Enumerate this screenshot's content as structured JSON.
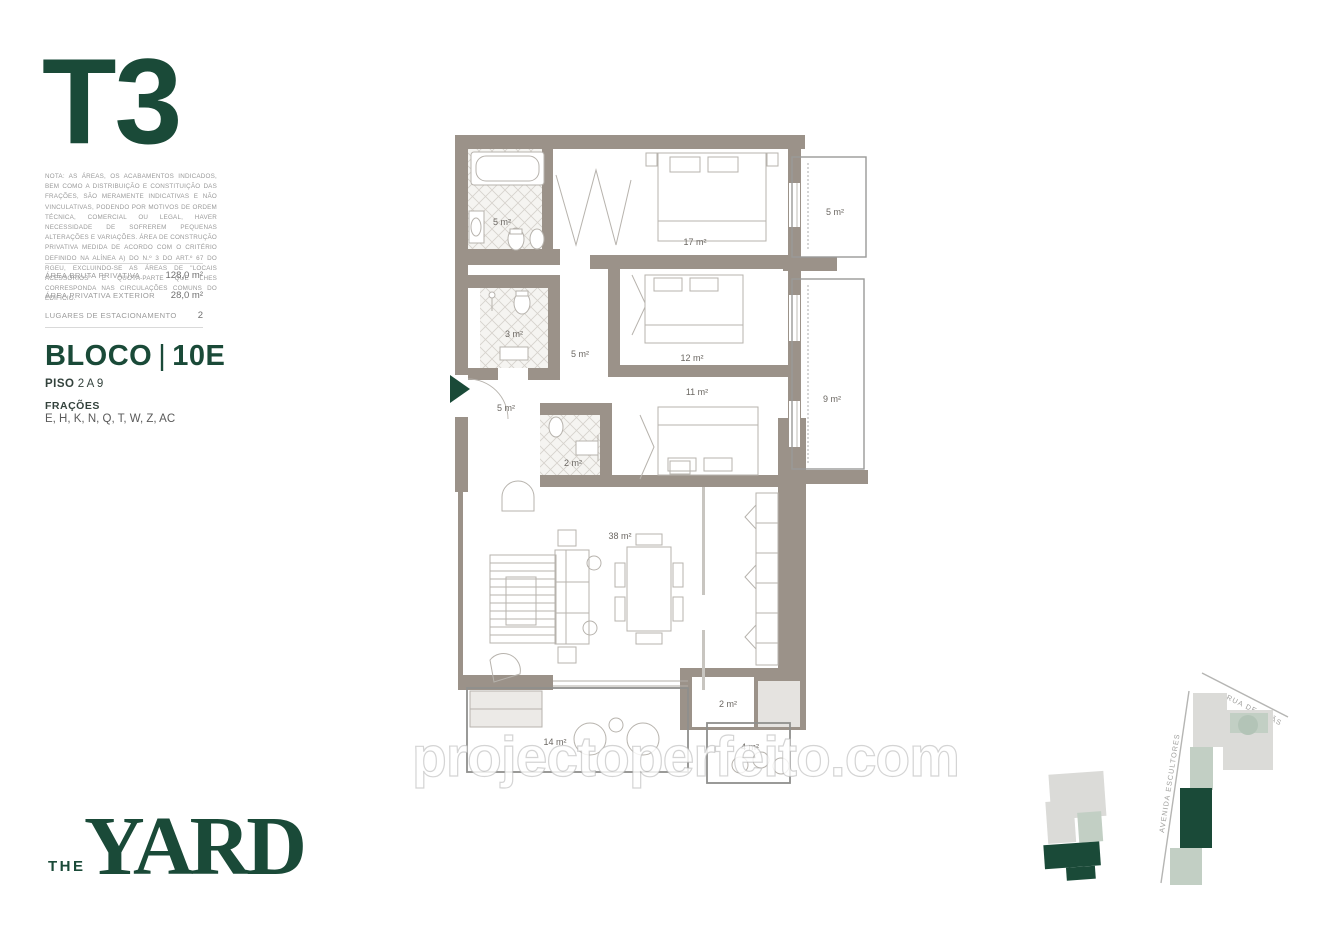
{
  "unit": {
    "type_label": "T3"
  },
  "disclaimer": "NOTA: AS ÁREAS, OS ACABAMENTOS INDICADOS, BEM COMO A DISTRIBUIÇÃO E CONSTITUIÇÃO DAS FRAÇÕES, SÃO MERAMENTE INDICATIVAS E NÃO VINCULATIVAS, PODENDO POR MOTIVOS DE ORDEM TÉCNICA, COMERCIAL OU LEGAL, HAVER NECESSIDADE DE SOFREREM PEQUENAS ALTERAÇÕES E VARIAÇÕES. ÁREA DE CONSTRUÇÃO PRIVATIVA MEDIDA DE ACORDO COM O CRITÉRIO DEFINIDO NA ALÍNEA A) DO N.º 3 DO ART.º 67 DO RGEU, EXCLUINDO-SE AS ÁREAS DE \"LOCAIS ACESSÓRIOS\" E QUOTA-PARTE QUE LHES CORRESPONDA NAS CIRCULAÇÕES COMUNS DO EDIFÍCIO.",
  "areas": {
    "rows": [
      {
        "label": "ÁREA BRUTA PRIVATIVA",
        "value": "128,0 m²"
      },
      {
        "label": "ÁREA PRIVATIVA EXTERIOR",
        "value": "28,0 m²"
      },
      {
        "label": "LUGARES DE ESTACIONAMENTO",
        "value": "2"
      }
    ]
  },
  "block": {
    "bloco_label": "BLOCO",
    "bloco_separator": "|",
    "bloco_number": "10E",
    "piso_label": "PISO",
    "piso_value": "2 A 9",
    "fracoes_label": "FRAÇÕES",
    "fracoes_value": "E, H, K, N, Q, T, W,  Z, AC"
  },
  "floor_plan": {
    "rooms": [
      {
        "name": "bathroom",
        "area": "5 m²"
      },
      {
        "name": "bedroom-1",
        "area": "17 m²"
      },
      {
        "name": "balcony-1",
        "area": "5 m²"
      },
      {
        "name": "shower-room",
        "area": "3 m²"
      },
      {
        "name": "hall",
        "area": "5 m²"
      },
      {
        "name": "bedroom-2",
        "area": "12 m²"
      },
      {
        "name": "bedroom-3",
        "area": "11 m²"
      },
      {
        "name": "balcony-2",
        "area": "9 m²"
      },
      {
        "name": "entry-hall",
        "area": "5 m²"
      },
      {
        "name": "wc",
        "area": "2 m²"
      },
      {
        "name": "living-dining",
        "area": "38 m²"
      },
      {
        "name": "laundry",
        "area": "2 m²"
      },
      {
        "name": "terrace-1",
        "area": "14 m²"
      },
      {
        "name": "terrace-2",
        "area": "4 m²"
      }
    ]
  },
  "watermark": "projectoperfeito.com",
  "logo": {
    "the": "THE",
    "yard": "YARD"
  },
  "site_map": {
    "streets": [
      {
        "name": "RUA DE CHÃS"
      },
      {
        "name": "AVENIDA ESCULTORES"
      }
    ]
  },
  "colors": {
    "accent_green": "#1a4a38",
    "wall_taupe": "#9b9289",
    "sage": "#c2cfc4",
    "block_gray": "#dbdbd8"
  }
}
